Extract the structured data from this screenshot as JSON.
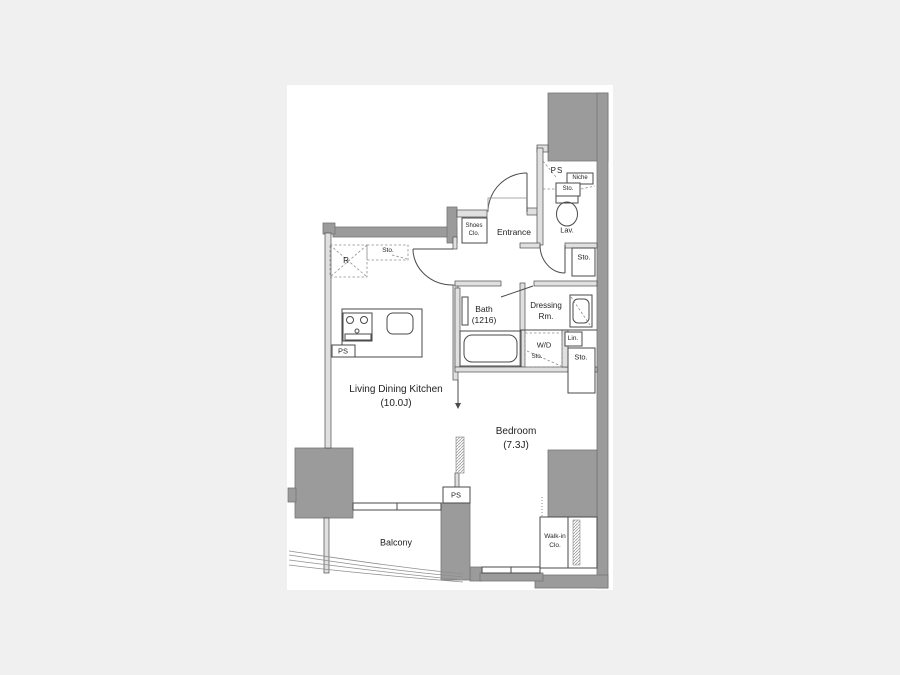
{
  "colors": {
    "background": "#f0f0f0",
    "floor": "#ffffff",
    "wall_dark": "#9b9b9b",
    "wall_dark_border": "#757575",
    "wall_light": "#e0e0e0",
    "line": "#4a4a4a",
    "line_light": "#8f8f8f",
    "text": "#1f1f1f"
  },
  "rooms": {
    "ldk": {
      "name": "Living Dining Kitchen",
      "size": "(10.0J)"
    },
    "bedroom": {
      "name": "Bedroom",
      "size": "(7.3J)"
    },
    "balcony": {
      "name": "Balcony"
    },
    "entrance": {
      "name": "Entrance"
    },
    "bath": {
      "name": "Bath",
      "size": "(1216)"
    },
    "dressing": {
      "line1": "Dressing",
      "line2": "Rm."
    },
    "lavatory": {
      "name": "Lav."
    },
    "walkin": {
      "line1": "Walk-in",
      "line2": "Clo."
    }
  },
  "labels": {
    "ps": "PS",
    "r": "R",
    "sto": "Sto.",
    "niche": "Niche",
    "wd": "W/D",
    "lin": "Lin.",
    "shoes_line1": "Shoes",
    "shoes_line2": "Clo."
  }
}
